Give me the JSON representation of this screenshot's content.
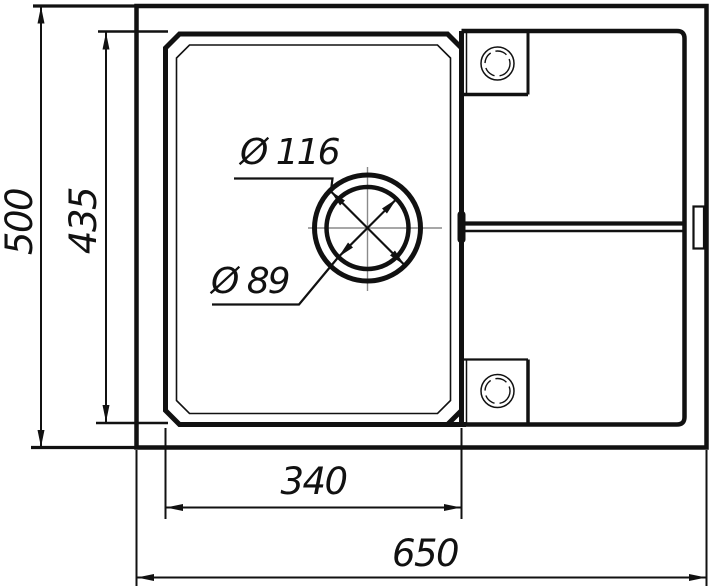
{
  "drawing": {
    "type": "technical-drawing",
    "subject": "kitchen-sink-top-view-dimension-drawing",
    "colors": {
      "line": "#111111",
      "centerline": "#8a8a8a",
      "background": "#ffffff"
    },
    "dimensions": {
      "overall_depth": "500",
      "bowl_depth": "435",
      "bowl_width": "340",
      "overall_width": "650",
      "drain_outer_dia": "Ø 116",
      "drain_inner_dia": "Ø 89"
    }
  }
}
